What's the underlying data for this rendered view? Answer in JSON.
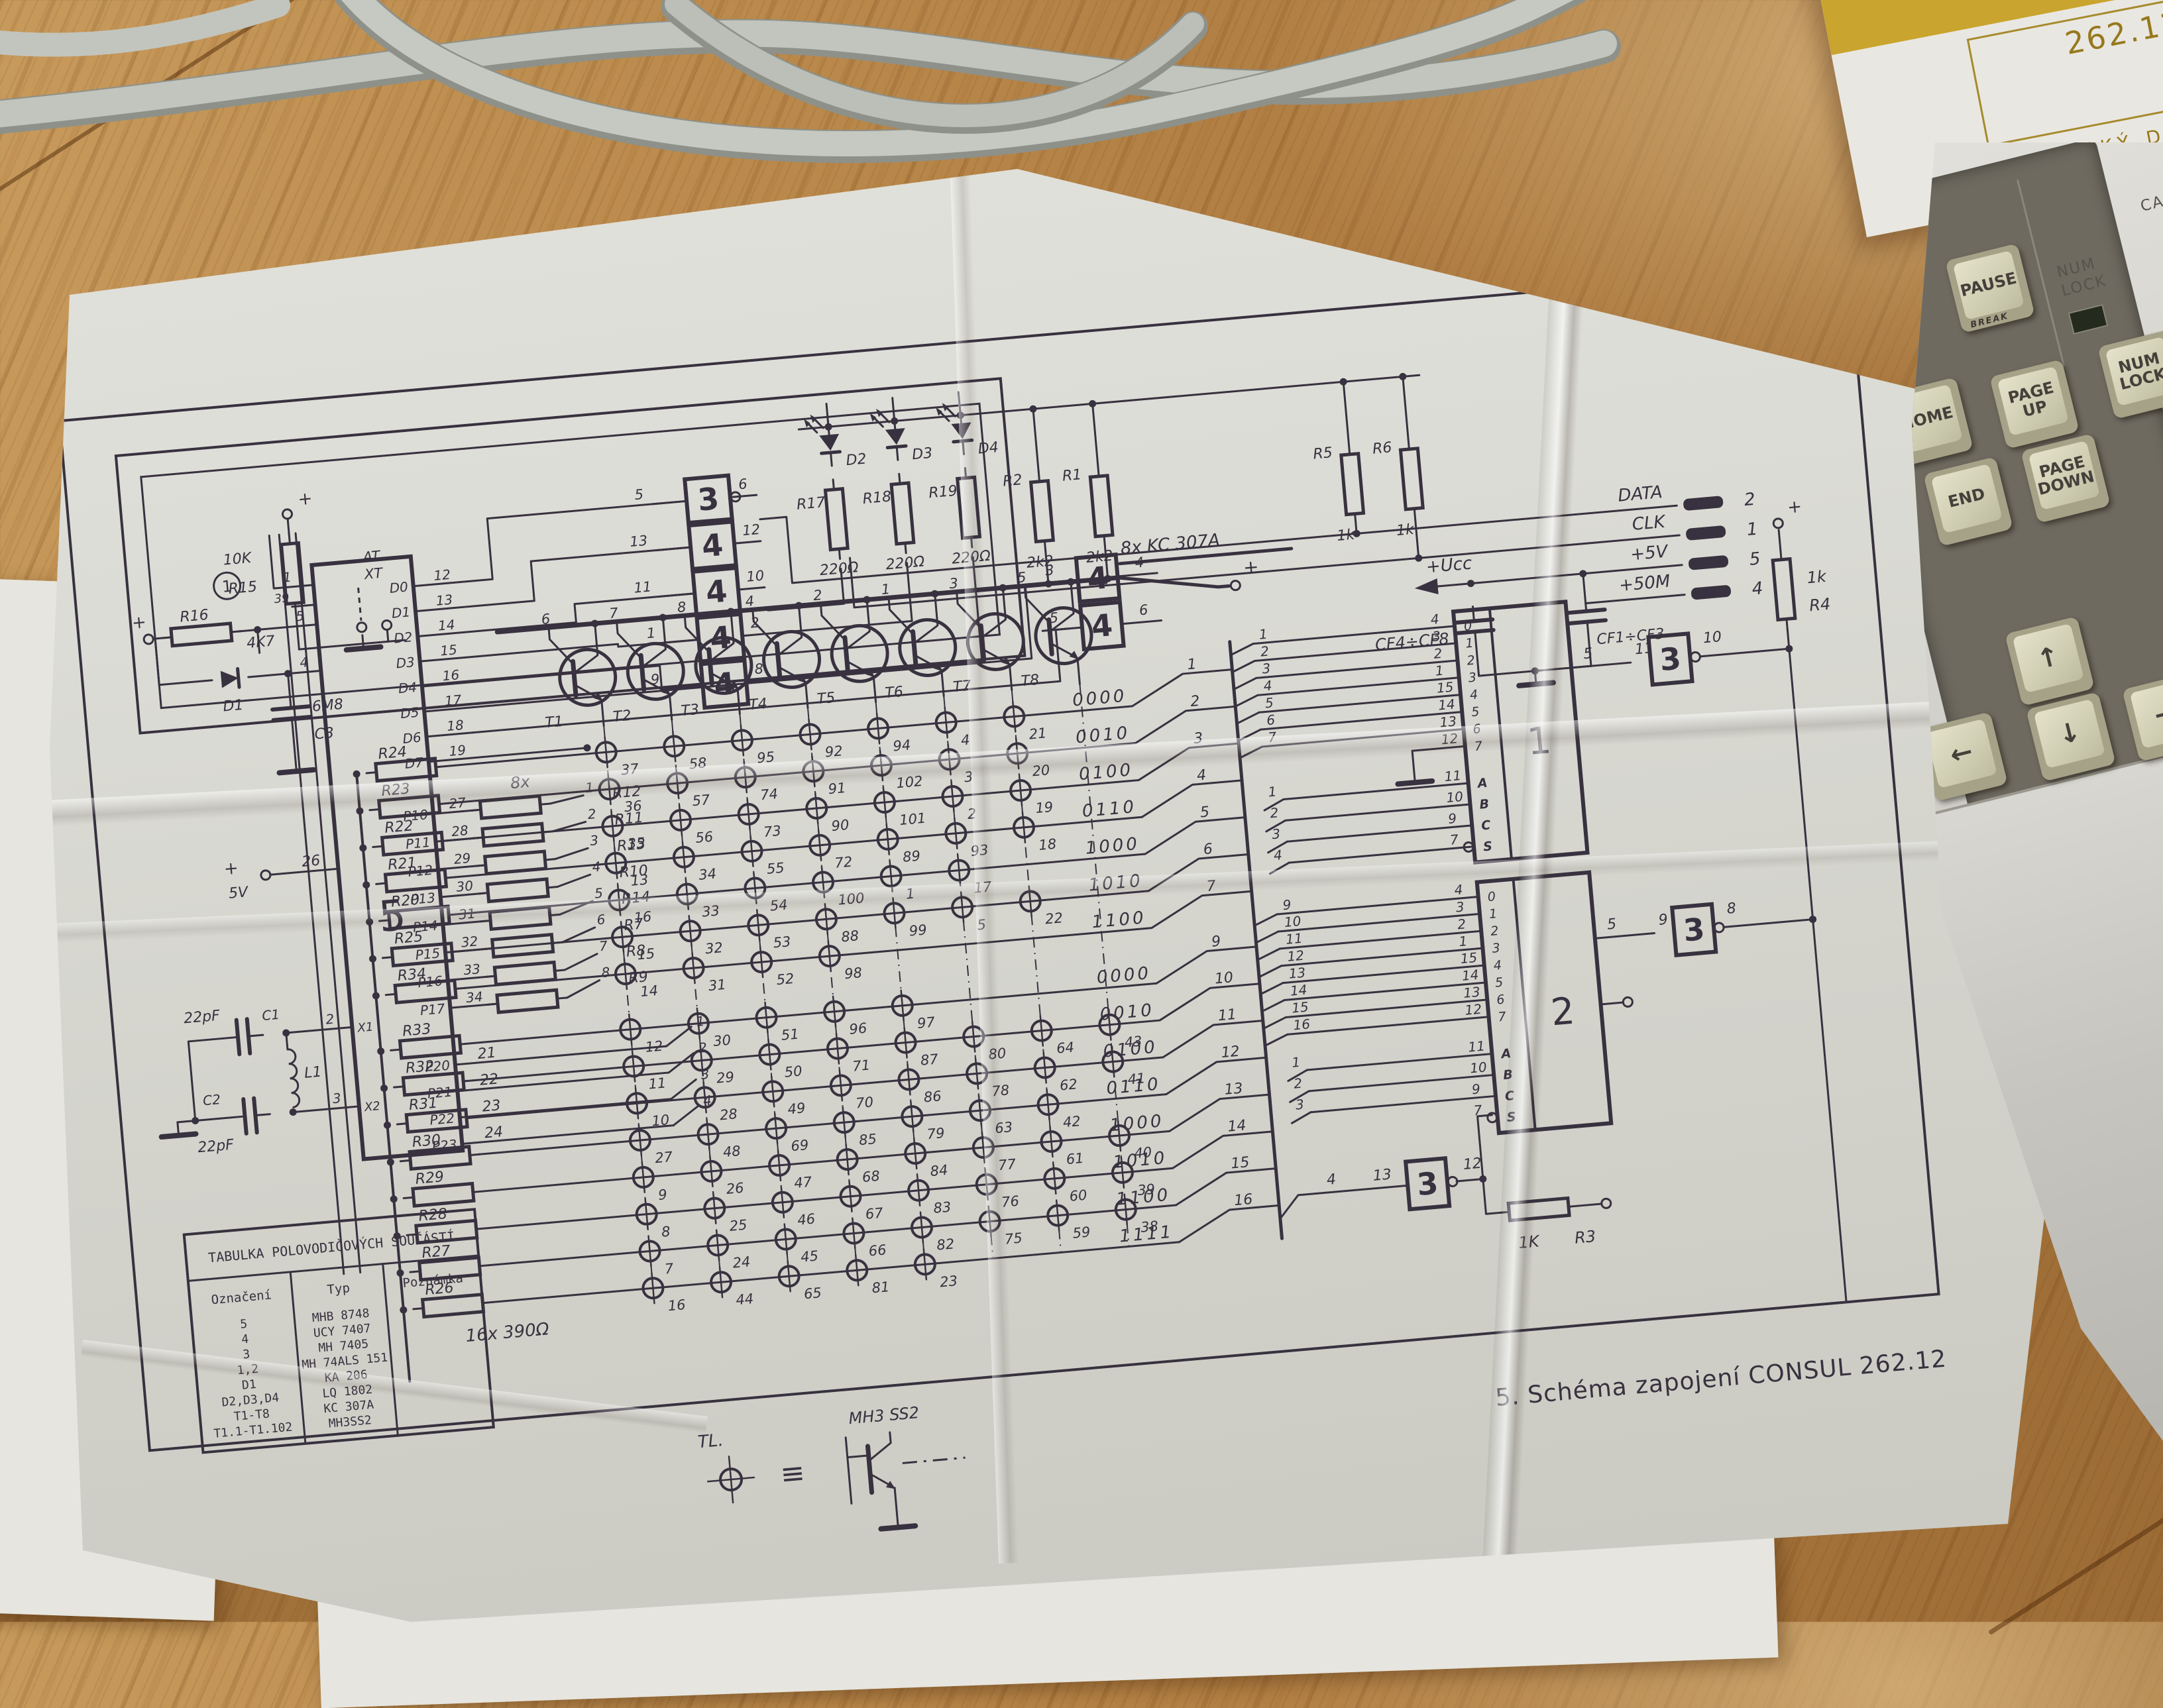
{
  "booklet": {
    "number": "262.12",
    "title": "TECHNICKÝ DENÍK"
  },
  "keyboard": {
    "indicator": "NUM LOCK",
    "caps_partial": "CA",
    "keys": {
      "pause": "PAUSE",
      "pause_front": "BREAK",
      "home": "HOME",
      "page_up": "PAGE UP",
      "num_lock": "NUM LOCK",
      "end": "END",
      "page_down": "PAGE DOWN",
      "up": "↑",
      "down": "↓",
      "left": "←",
      "right": "→"
    }
  },
  "caption": "5. Schéma zapojení CONSUL 262.12",
  "legend": {
    "tl": "TL.",
    "equiv": "≡",
    "type": "MH3 SS2"
  },
  "table": {
    "title": "TABULKA POLOVODIČOVÝCH SOUČÁSTÍ",
    "columns": [
      "Označení",
      "Typ",
      "Poznámka"
    ],
    "rows": [
      [
        "5",
        "MHB 8748",
        ""
      ],
      [
        "4",
        "UCY 7407",
        ""
      ],
      [
        "3",
        "MH 7405",
        ""
      ],
      [
        "1,2",
        "MH 74ALS 151",
        ""
      ],
      [
        "D1",
        "KA 206",
        ""
      ],
      [
        "D2,D3,D4",
        "LQ 1802",
        ""
      ],
      [
        "T1-T8",
        "KC 307A",
        ""
      ],
      [
        "T1.1-T1.102",
        "MH3SS2",
        ""
      ]
    ]
  },
  "schematic": {
    "top": {
      "circled": "1",
      "r15": {
        "name": "R15",
        "value": "10K"
      },
      "switch": [
        "AT",
        "XT"
      ],
      "leds": [
        "D2",
        "D3",
        "D4"
      ],
      "led_resistors": [
        {
          "name": "R17",
          "value": "220Ω"
        },
        {
          "name": "R18",
          "value": "220Ω"
        },
        {
          "name": "R19",
          "value": "220Ω"
        }
      ],
      "pull_resistors": [
        {
          "name": "R2",
          "value": "2k2"
        },
        {
          "name": "R1",
          "value": "2k2"
        },
        {
          "name": "R5",
          "value": "1k"
        },
        {
          "name": "R6",
          "value": "1k"
        }
      ]
    },
    "gate_column": [
      {
        "label": "3",
        "in": "5",
        "out": "6"
      },
      {
        "label": "4",
        "in": "13",
        "out": "12"
      },
      {
        "label": "4",
        "in": "11",
        "out": "10"
      },
      {
        "label": "4",
        "in": "1",
        "out": "2"
      },
      {
        "label": "4",
        "in": "9",
        "out": "8"
      }
    ],
    "mid_gates": [
      {
        "label": "4",
        "in": "3",
        "out": "4"
      },
      {
        "label": "4",
        "in": "5",
        "out": "6"
      }
    ],
    "connector": {
      "signals": [
        {
          "name": "DATA",
          "pin": "2"
        },
        {
          "name": "CLK",
          "pin": "1"
        },
        {
          "name": "+5V",
          "pin": "5"
        },
        {
          "name": "+50M",
          "pin": "4"
        }
      ],
      "ucc": "+Ucc",
      "cap_groups": [
        "CF4÷CF8",
        "CF1÷CF3"
      ]
    },
    "cpu": {
      "label": "5",
      "data_pins": [
        {
          "name": "D0",
          "pin": "12"
        },
        {
          "name": "D1",
          "pin": "13"
        },
        {
          "name": "D2",
          "pin": "14"
        },
        {
          "name": "D3",
          "pin": "15"
        },
        {
          "name": "D4",
          "pin": "16"
        },
        {
          "name": "D5",
          "pin": "17"
        },
        {
          "name": "D6",
          "pin": "18"
        },
        {
          "name": "D7",
          "pin": "19"
        }
      ],
      "port1_pins": [
        {
          "name": "P10",
          "pin": "27",
          "n": "1",
          "res": "R12"
        },
        {
          "name": "P11",
          "pin": "28",
          "n": "2",
          "res": "R11"
        },
        {
          "name": "P12",
          "pin": "29",
          "n": "3",
          "res": "R13"
        },
        {
          "name": "P13",
          "pin": "30",
          "n": "4",
          "res": "R10"
        },
        {
          "name": "P14",
          "pin": "31",
          "n": "5",
          "res": "R14"
        },
        {
          "name": "P15",
          "pin": "32",
          "n": "6",
          "res": "R7"
        },
        {
          "name": "P16",
          "pin": "33",
          "n": "7",
          "res": "R8"
        },
        {
          "name": "P17",
          "pin": "34",
          "n": "8",
          "res": "R9"
        }
      ],
      "port1_prefix": "8x",
      "port2_pins": [
        {
          "name": "P20",
          "pin": "21",
          "n": "1"
        },
        {
          "name": "P21",
          "pin": "22",
          "n": "2"
        },
        {
          "name": "P22",
          "pin": "23",
          "n": "3"
        },
        {
          "name": "P23",
          "pin": "24",
          "n": "4"
        }
      ],
      "left_pins": {
        "p1": "1",
        "p39": "39",
        "p5": "5",
        "p4": "4",
        "p26": "26",
        "p26_label": "+ 5V",
        "x1": "X1",
        "x1_pin": "2",
        "x2": "X2",
        "x2_pin": "3"
      }
    },
    "left_parts": {
      "plus": "+",
      "r16": {
        "name": "R16",
        "value": "4K7"
      },
      "d1": "D1",
      "c3": {
        "name": "C3",
        "value": "6M8"
      },
      "c1": {
        "name": "C1",
        "value": "22pF"
      },
      "l1": "L1",
      "c2": {
        "name": "C2",
        "value": "22pF"
      }
    },
    "transistors": {
      "group_label": "8x KC 307A",
      "plus": "+",
      "names": [
        "T1",
        "T2",
        "T3",
        "T4",
        "T5",
        "T6",
        "T7",
        "T8"
      ],
      "bases": [
        "6",
        "7",
        "8",
        "4",
        "2",
        "1",
        "3",
        "5"
      ]
    },
    "matrix": {
      "bottom_label": "16x 390Ω",
      "rows": [
        {
          "res": "R24",
          "keys": [
            "37",
            "58",
            "95",
            "92",
            "94",
            "4",
            "21"
          ],
          "code": "0000",
          "pin": "1"
        },
        {
          "res": "R23",
          "keys": [
            "36",
            "57",
            "74",
            "91",
            "102",
            "3",
            "20"
          ],
          "code": "0010",
          "pin": "2"
        },
        {
          "res": "R22",
          "keys": [
            "35",
            "56",
            "73",
            "90",
            "101",
            "2",
            "19"
          ],
          "code": "0100",
          "pin": "3"
        },
        {
          "res": "R21",
          "keys": [
            "13",
            "34",
            "55",
            "72",
            "89",
            "93",
            "18"
          ],
          "code": "0110",
          "pin": "4"
        },
        {
          "res": "R20",
          "keys": [
            "16",
            "33",
            "54",
            "100",
            "1",
            "17"
          ],
          "code": "1000",
          "pin": "5"
        },
        {
          "res": "R25",
          "keys": [
            "15",
            "32",
            "53",
            "88",
            "99",
            "5",
            "22"
          ],
          "code": "1010",
          "pin": "6"
        },
        {
          "res": "R34",
          "keys": [
            "14",
            "31",
            "52",
            "98"
          ],
          "code": "1100",
          "pin": "7"
        },
        {
          "res": "R33",
          "keys": [
            "12",
            "30",
            "51",
            "96",
            "97"
          ],
          "code": "0000",
          "pin": "9"
        },
        {
          "res": "R32",
          "keys": [
            "11",
            "29",
            "50",
            "71",
            "87",
            "80",
            "64",
            "43"
          ],
          "code": "0010",
          "pin": "10"
        },
        {
          "res": "R31",
          "keys": [
            "10",
            "28",
            "49",
            "70",
            "86",
            "78",
            "62",
            "41"
          ],
          "code": "0100",
          "pin": "11"
        },
        {
          "res": "R30",
          "keys": [
            "27",
            "48",
            "69",
            "85",
            "79",
            "63",
            "42"
          ],
          "code": "0110",
          "pin": "12"
        },
        {
          "res": "R29",
          "keys": [
            "9",
            "26",
            "47",
            "68",
            "84",
            "77",
            "61",
            "40"
          ],
          "code": "1000",
          "pin": "13"
        },
        {
          "res": "R28",
          "keys": [
            "8",
            "25",
            "46",
            "67",
            "83",
            "76",
            "60",
            "39"
          ],
          "code": "1010",
          "pin": "14"
        },
        {
          "res": "R27",
          "keys": [
            "7",
            "24",
            "45",
            "66",
            "82",
            "75",
            "59",
            "38"
          ],
          "code": "1100",
          "pin": "15"
        },
        {
          "res": "R26",
          "keys": [
            "16",
            "44",
            "65",
            "81",
            "23"
          ],
          "code": "1111",
          "pin": "16"
        }
      ]
    },
    "mux1": {
      "label": "1",
      "in_rows": [
        [
          "1",
          "4",
          "0"
        ],
        [
          "2",
          "3",
          "1"
        ],
        [
          "3",
          "2",
          "2"
        ],
        [
          "4",
          "1",
          "3"
        ],
        [
          "5",
          "15",
          "4"
        ],
        [
          "6",
          "14",
          "5"
        ],
        [
          "7",
          "13",
          "6"
        ]
      ],
      "gnd_pin": "12",
      "gnd_internal": "7",
      "sel": [
        [
          "1",
          "11",
          "A"
        ],
        [
          "2",
          "10",
          "B"
        ],
        [
          "3",
          "9",
          "C"
        ],
        [
          "4",
          "7",
          "S"
        ]
      ],
      "out": {
        "chip_pin": "5",
        "gate_in": "11",
        "gate": "3",
        "gate_out": "10"
      },
      "pullup": {
        "name": "R4",
        "value": "1k",
        "plus": "+"
      }
    },
    "mux2": {
      "label": "2",
      "in_rows": [
        [
          "9",
          "4",
          "0"
        ],
        [
          "10",
          "3",
          "1"
        ],
        [
          "11",
          "2",
          "2"
        ],
        [
          "12",
          "1",
          "3"
        ],
        [
          "13",
          "15",
          "4"
        ],
        [
          "14",
          "14",
          "5"
        ],
        [
          "15",
          "13",
          "6"
        ],
        [
          "16",
          "12",
          "7"
        ]
      ],
      "sel": [
        [
          "1",
          "11",
          "A"
        ],
        [
          "2",
          "10",
          "B"
        ],
        [
          "3",
          "9",
          "C"
        ],
        [
          "",
          "7",
          "S"
        ]
      ],
      "out": {
        "chip_pin": "5",
        "gate_in": "9",
        "gate": "3",
        "gate_out": "8"
      },
      "sgate": {
        "in_a": "4",
        "in_b": "13",
        "label": "3",
        "out": "12"
      },
      "r3": {
        "name": "R3",
        "value": "1K"
      }
    }
  }
}
